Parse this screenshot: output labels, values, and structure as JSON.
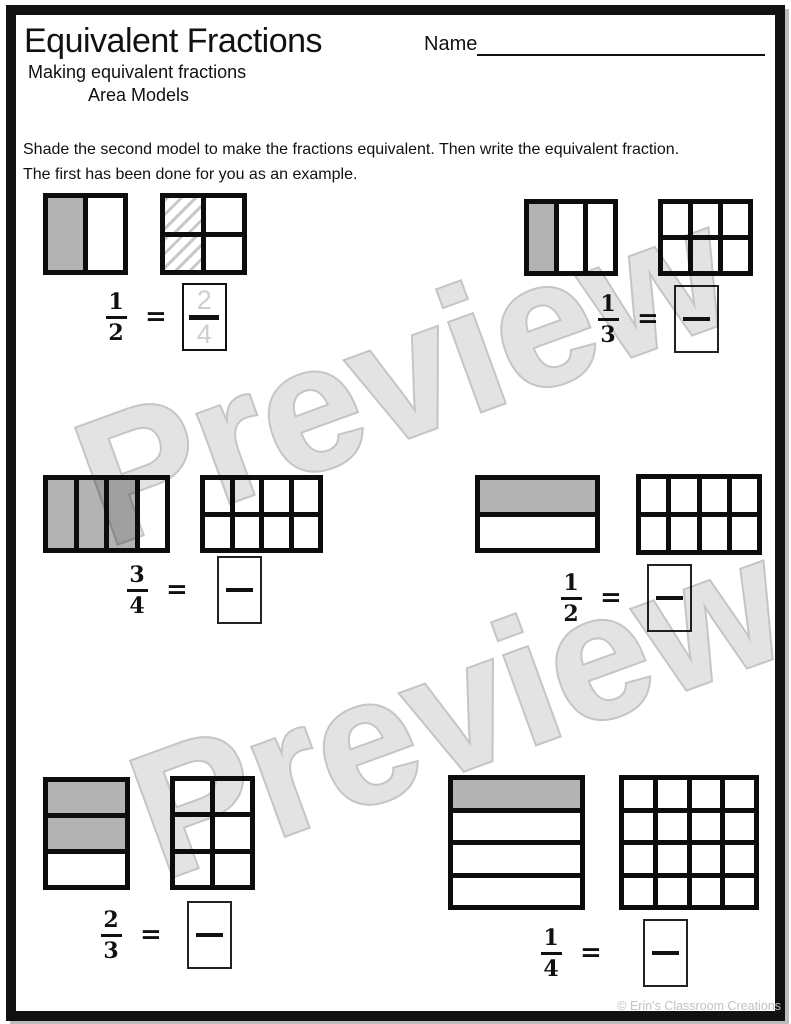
{
  "page": {
    "title": "Equivalent Fractions",
    "name_label": "Name",
    "subtitle_line1": "Making equivalent fractions",
    "subtitle_line2": "Area Models",
    "instructions_line1": "Shade the second model to make the fractions equivalent. Then write the equivalent fraction.",
    "instructions_line2": "The first has been done for you as an example.",
    "watermark": "Preview",
    "footer_credit": "© Erin's Classroom Creations",
    "equals_sign": "="
  },
  "colors": {
    "grid_line": "#0d0d0d",
    "shaded_cell": "#b3b3b3",
    "hatch_stroke": "#c8c8c8",
    "watermark_fill": "#e3e3e3",
    "watermark_outline": "#c5c5c5",
    "example_answer_ink": "#cfcfcf"
  },
  "problems": [
    {
      "id": 1,
      "given_fraction": {
        "numerator": "1",
        "denominator": "2"
      },
      "given_model": {
        "rows": 1,
        "cols": 2,
        "shaded_cells": [
          0
        ],
        "hatched_cells": []
      },
      "answer_model": {
        "rows": 2,
        "cols": 2,
        "shaded_cells": [],
        "hatched_cells": [
          0,
          2
        ]
      },
      "answer": {
        "numerator": "2",
        "denominator": "4",
        "is_example": true
      }
    },
    {
      "id": 2,
      "given_fraction": {
        "numerator": "1",
        "denominator": "3"
      },
      "given_model": {
        "rows": 1,
        "cols": 3,
        "shaded_cells": [
          0
        ],
        "hatched_cells": []
      },
      "answer_model": {
        "rows": 2,
        "cols": 3,
        "shaded_cells": [],
        "hatched_cells": []
      },
      "answer": {
        "numerator": "",
        "denominator": "",
        "is_example": false
      }
    },
    {
      "id": 3,
      "given_fraction": {
        "numerator": "3",
        "denominator": "4"
      },
      "given_model": {
        "rows": 1,
        "cols": 4,
        "shaded_cells": [
          0,
          1,
          2
        ],
        "hatched_cells": []
      },
      "answer_model": {
        "rows": 2,
        "cols": 4,
        "shaded_cells": [],
        "hatched_cells": []
      },
      "answer": {
        "numerator": "",
        "denominator": "",
        "is_example": false
      }
    },
    {
      "id": 4,
      "given_fraction": {
        "numerator": "1",
        "denominator": "2"
      },
      "given_model": {
        "rows": 2,
        "cols": 1,
        "shaded_cells": [
          0
        ],
        "hatched_cells": []
      },
      "answer_model": {
        "rows": 2,
        "cols": 4,
        "shaded_cells": [],
        "hatched_cells": []
      },
      "answer": {
        "numerator": "",
        "denominator": "",
        "is_example": false
      }
    },
    {
      "id": 5,
      "given_fraction": {
        "numerator": "2",
        "denominator": "3"
      },
      "given_model": {
        "rows": 3,
        "cols": 1,
        "shaded_cells": [
          0,
          1
        ],
        "hatched_cells": []
      },
      "answer_model": {
        "rows": 3,
        "cols": 2,
        "shaded_cells": [],
        "hatched_cells": []
      },
      "answer": {
        "numerator": "",
        "denominator": "",
        "is_example": false
      }
    },
    {
      "id": 6,
      "given_fraction": {
        "numerator": "1",
        "denominator": "4"
      },
      "given_model": {
        "rows": 4,
        "cols": 1,
        "shaded_cells": [
          0
        ],
        "hatched_cells": []
      },
      "answer_model": {
        "rows": 4,
        "cols": 4,
        "shaded_cells": [],
        "hatched_cells": []
      },
      "answer": {
        "numerator": "",
        "denominator": "",
        "is_example": false
      }
    }
  ]
}
